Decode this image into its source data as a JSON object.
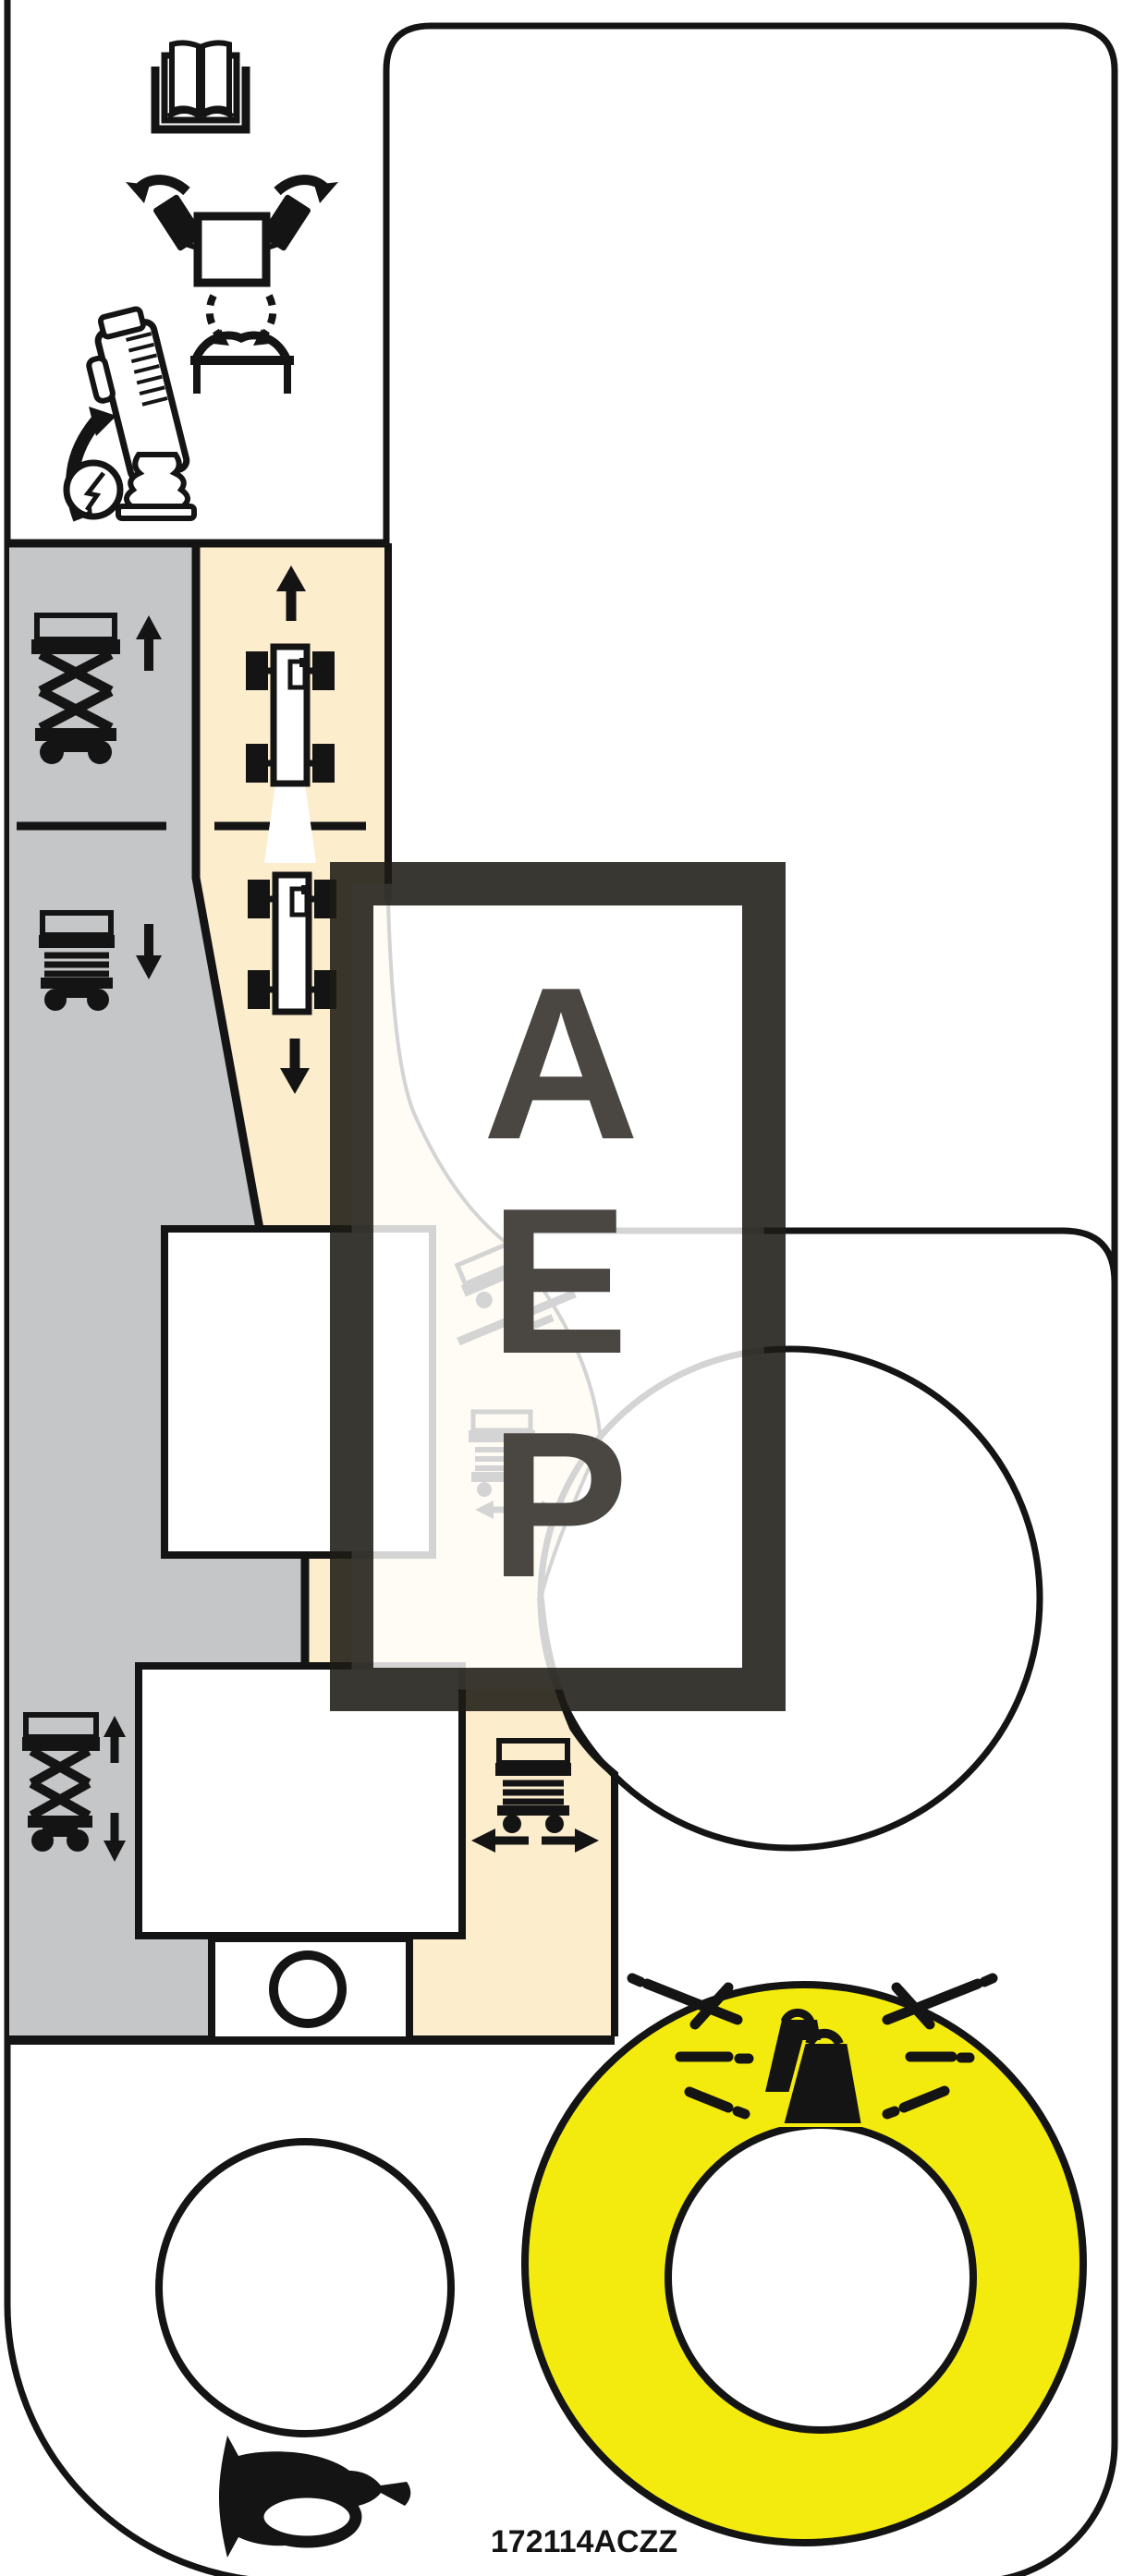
{
  "label": {
    "part_number": "172114ACZZ",
    "type": "scissor-lift-control-panel-decal"
  },
  "overlay": {
    "letters": [
      "A",
      "E",
      "P"
    ]
  },
  "colors": {
    "gray": "#c5c6c8",
    "beige": "#fcedcd",
    "yellow": "#f4eb0e",
    "ink": "#141414",
    "letter": "#4a4742",
    "overlay_frame": "rgba(30,27,21,0.88)",
    "overlay_fill": "rgba(255,255,255,0.82)"
  },
  "icons": [
    "manual-book-icon",
    "steering-wheels-icon",
    "joystick-tilt-icon",
    "electric-hazard-icon",
    "platform-seat-icon",
    "scissor-raise-icon",
    "drive-forward-icon",
    "platform-lower-icon",
    "drive-reverse-icon",
    "slope-drive-icon",
    "platform-shift-icon",
    "scissor-raise-lower-icon",
    "platform-drive-left-right-icon",
    "overload-weights-icon",
    "spark-marks-icon",
    "horn-icon"
  ]
}
